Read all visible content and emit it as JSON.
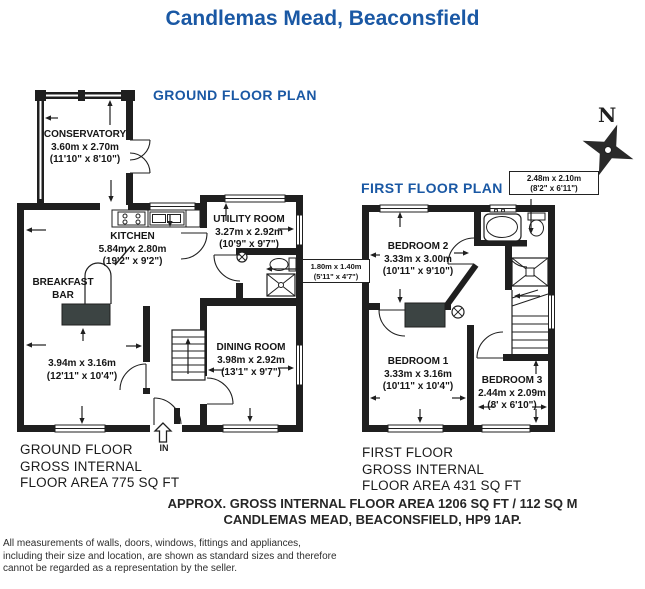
{
  "title": "Candlemas Mead, Beaconsfield",
  "colors": {
    "accent_blue": "#1a58a4",
    "wall_black": "#1f1f1f",
    "furniture_dark": "#3c4443"
  },
  "compass": {
    "north_label": "N"
  },
  "ground_floor": {
    "plan_title": "GROUND FLOOR PLAN",
    "entrance_label": "IN",
    "area_lines": [
      "GROUND FLOOR",
      "GROSS INTERNAL",
      "FLOOR AREA 775 SQ FT"
    ],
    "rooms": {
      "conservatory": {
        "name": "CONSERVATORY",
        "metric": "3.60m x 2.70m",
        "imperial": "(11'10\" x 8'10\")"
      },
      "kitchen": {
        "name": "KITCHEN",
        "metric": "5.84m x 2.80m",
        "imperial": "(19'2\" x 9'2\")"
      },
      "breakfast_bar": {
        "line1": "BREAKFAST",
        "line2": "BAR"
      },
      "living_room": {
        "metric": "3.94m x 3.16m",
        "imperial": "(12'11\" x 10'4\")"
      },
      "dining_room": {
        "name": "DINING ROOM",
        "metric": "3.98m x 2.92m",
        "imperial": "(13'1\" x 9'7\")"
      },
      "utility_room": {
        "name": "UTILITY ROOM",
        "metric": "3.27m x 2.92m",
        "imperial": "(10'9\" x 9'7\")"
      },
      "wc": {
        "metric": "1.80m x 1.40m",
        "imperial": "(5'11\" x 4'7\")"
      }
    }
  },
  "first_floor": {
    "plan_title": "FIRST FLOOR PLAN",
    "area_lines": [
      "FIRST FLOOR",
      "GROSS INTERNAL",
      "FLOOR AREA 431 SQ FT"
    ],
    "rooms": {
      "bedroom2": {
        "name": "BEDROOM 2",
        "metric": "3.33m x 3.00m",
        "imperial": "(10'11\" x 9'10\")"
      },
      "bedroom1": {
        "name": "BEDROOM 1",
        "metric": "3.33m x 3.16m",
        "imperial": "(10'11\" x 10'4\")"
      },
      "bedroom3": {
        "name": "BEDROOM 3",
        "metric": "2.44m x 2.09m",
        "imperial": "(8' x 6'10\")"
      },
      "bathroom": {
        "metric": "2.48m x 2.10m",
        "imperial": "(8'2\" x 6'11\")"
      }
    }
  },
  "footer": {
    "approx_line1": "APPROX. GROSS INTERNAL FLOOR AREA 1206 SQ FT / 112 SQ M",
    "approx_line2": "CANDLEMAS MEAD, BEACONSFIELD, HP9 1AP.",
    "disclaimer_lines": [
      "All measurements of walls, doors, windows, fittings and appliances,",
      "including their size and location, are shown as standard sizes and therefore",
      "cannot be regarded as a representation by the seller."
    ]
  }
}
